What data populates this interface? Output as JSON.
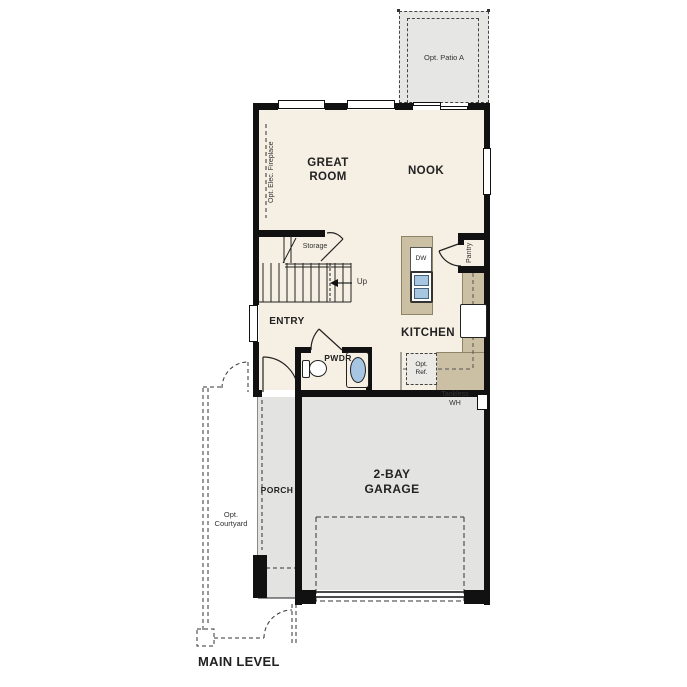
{
  "plan": {
    "title": "MAIN LEVEL",
    "patio": {
      "label": "Opt. Patio A"
    },
    "great_room": {
      "label": "GREAT ROOM"
    },
    "nook": {
      "label": "NOOK"
    },
    "fireplace": {
      "label": "Opt. Elec. Fireplace"
    },
    "stairs": {
      "storage_label": "Storage",
      "up_label": "Up"
    },
    "entry": {
      "label": "ENTRY"
    },
    "kitchen": {
      "label": "KITCHEN",
      "dishwasher_label": "DW",
      "pantry_label": "Pantry",
      "opt_ref_label": "Opt. Ref."
    },
    "powder": {
      "label": "PWDR"
    },
    "garage": {
      "label": "2-BAY GARAGE",
      "tankless_label": "Tankless WH"
    },
    "porch": {
      "label": "PORCH"
    },
    "courtyard": {
      "label": "Opt. Courtyard"
    }
  },
  "colors": {
    "floor": "#f6efe3",
    "exterior_concrete": "#e4e4e2",
    "counter": "#cbc0a4",
    "sink_blue": "#a7c6e2",
    "wall": "#111111",
    "line": "#222222"
  }
}
